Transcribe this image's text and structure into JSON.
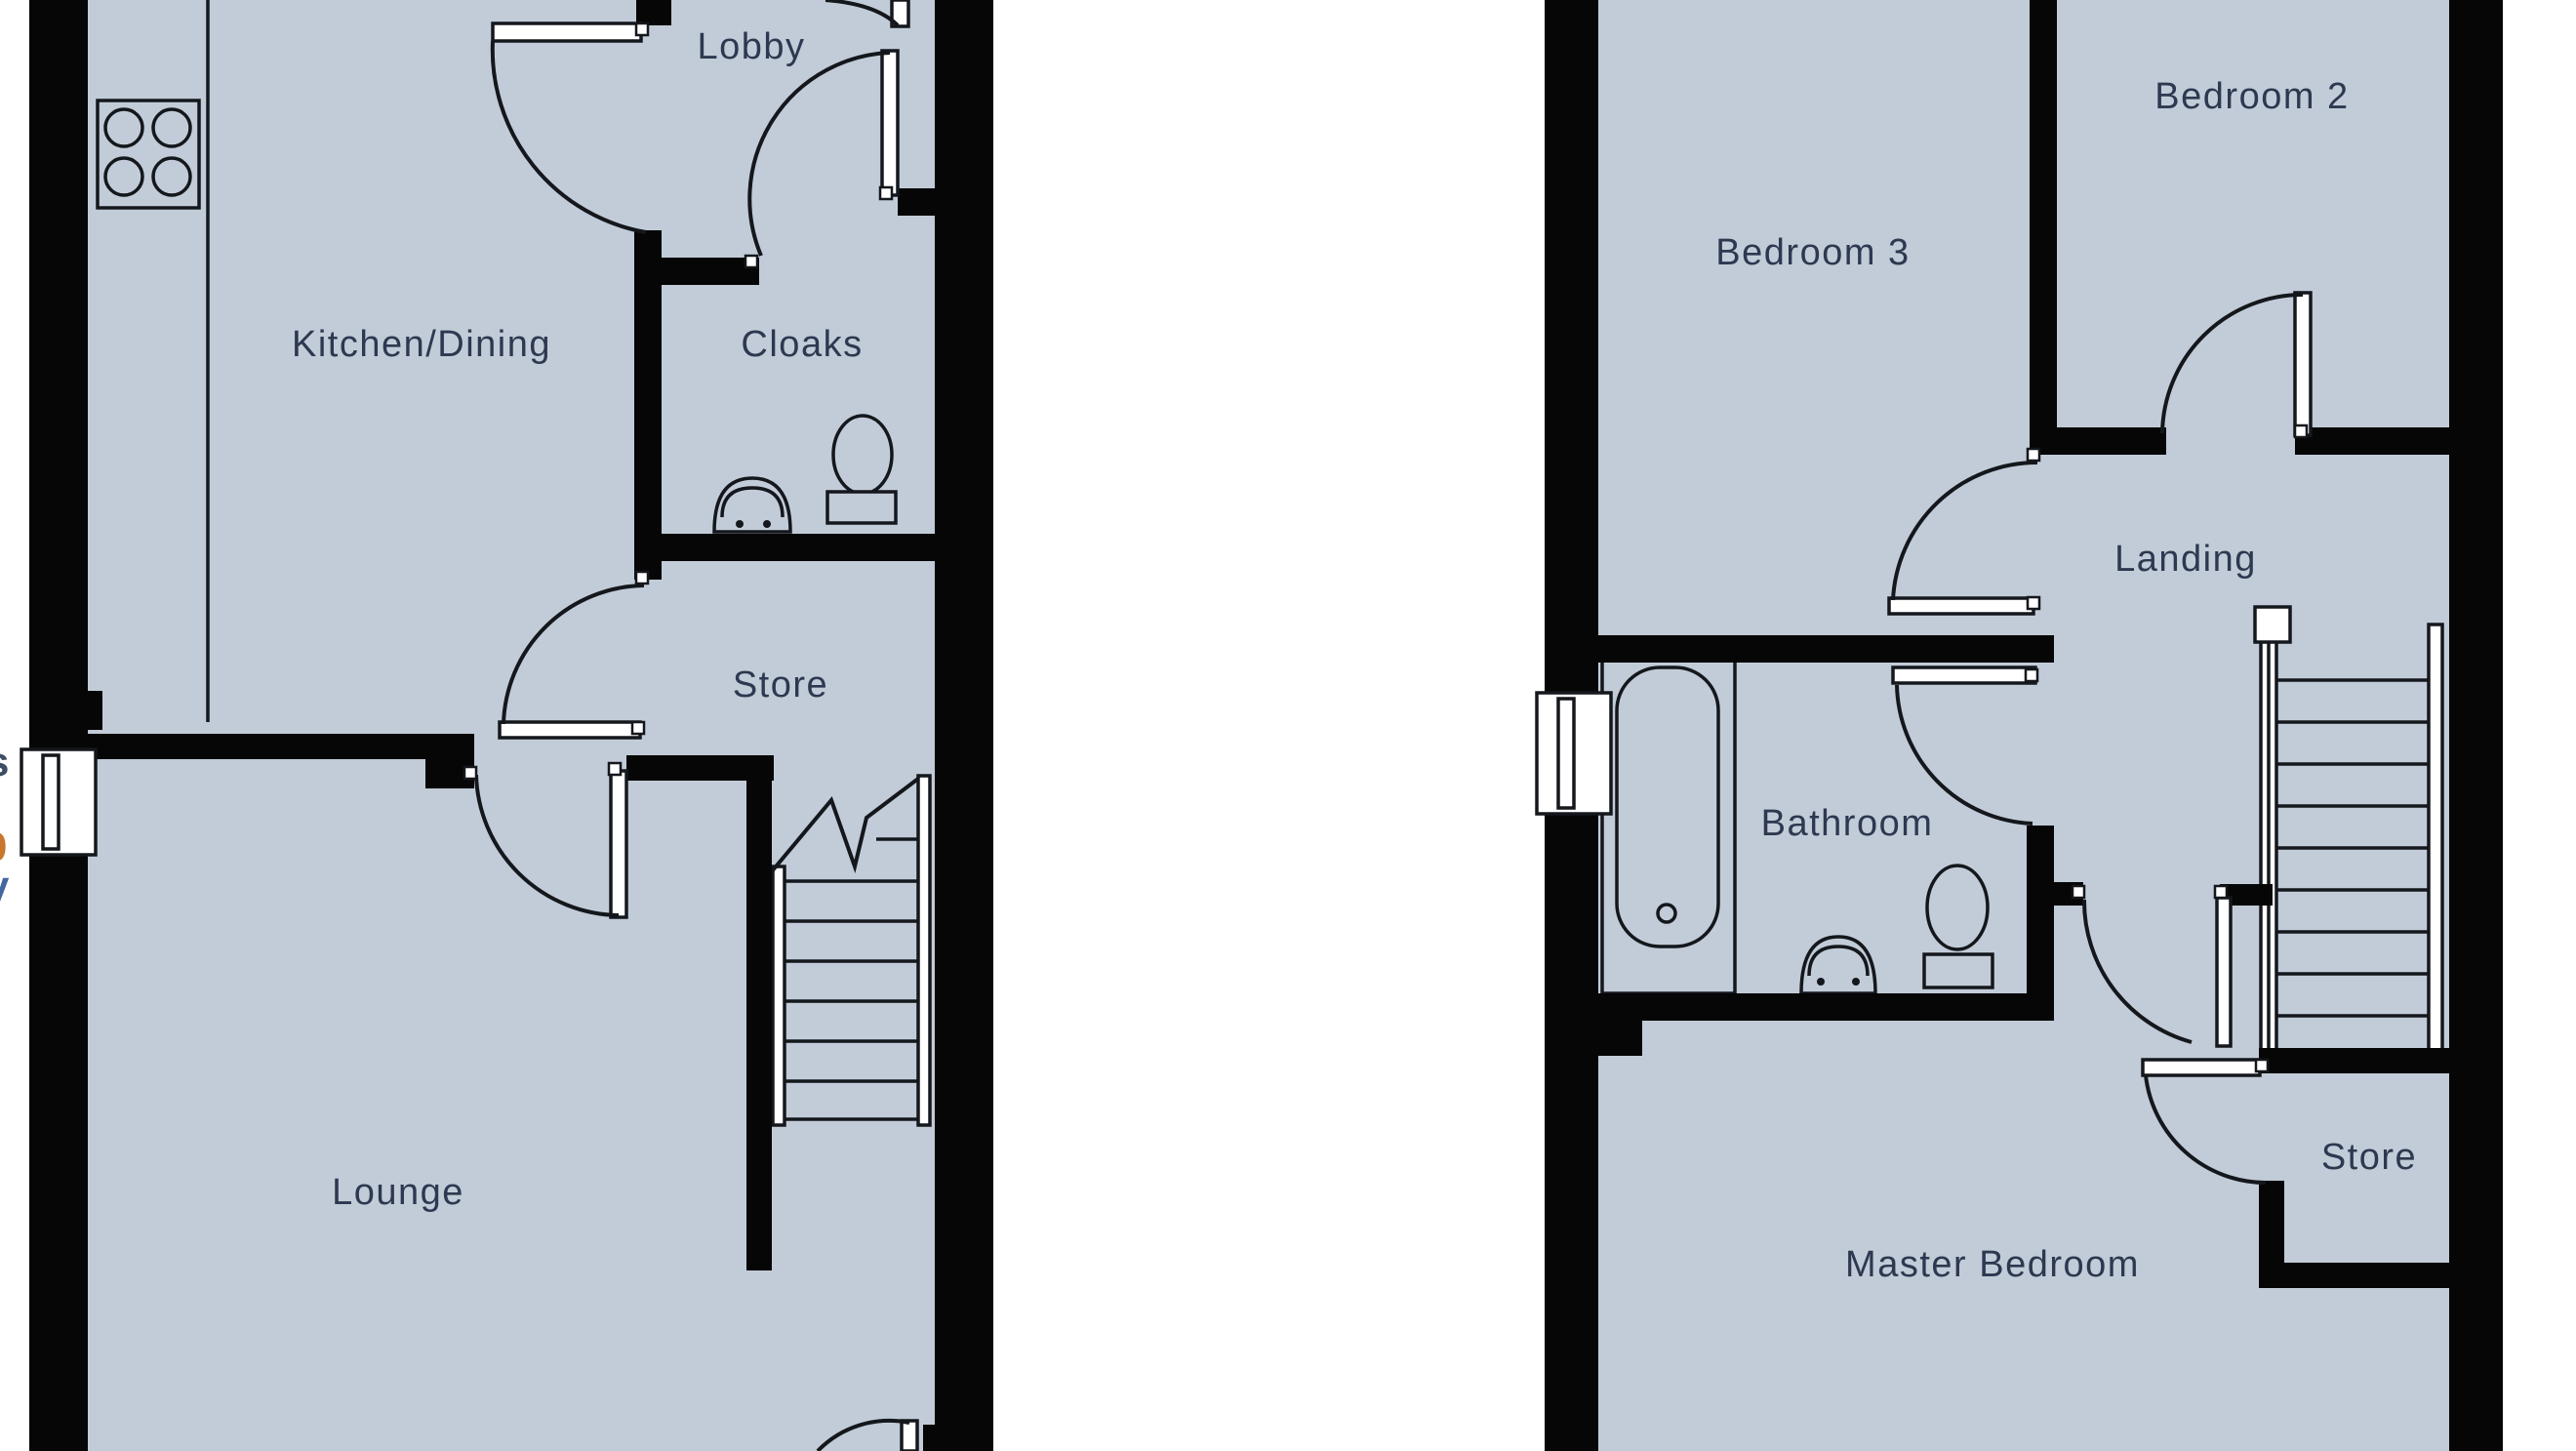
{
  "colors": {
    "floor": "#c2ccd8",
    "wall": "#060606",
    "line": "#14171c",
    "label": "#2e3850",
    "fragment_dark": "#3c4d66",
    "fragment_orange": "#c8772c",
    "fragment_blue": "#44679f"
  },
  "plans": [
    {
      "id": "ground-floor",
      "rooms": [
        "Lobby",
        "Kitchen/Dining",
        "Cloaks",
        "Store",
        "Lounge"
      ],
      "fixtures": [
        "hob-icon",
        "toilet-icon",
        "sink-icon",
        "staircase-icon",
        "window-icon",
        "door-swing-icon"
      ]
    },
    {
      "id": "first-floor",
      "rooms": [
        "Bedroom 3",
        "Bedroom 2",
        "Landing",
        "Bathroom",
        "Store",
        "Master Bedroom"
      ],
      "fixtures": [
        "bath-icon",
        "toilet-icon",
        "sink-icon",
        "staircase-icon",
        "window-icon",
        "door-swing-icon"
      ]
    }
  ],
  "edge_fragments": [
    {
      "text": "s",
      "color": "#3c4d66"
    },
    {
      "text": ",",
      "color": "#b8762f"
    },
    {
      "text": "0",
      "color": "#c8772c"
    },
    {
      "text": "y",
      "color": "#44679f"
    }
  ]
}
